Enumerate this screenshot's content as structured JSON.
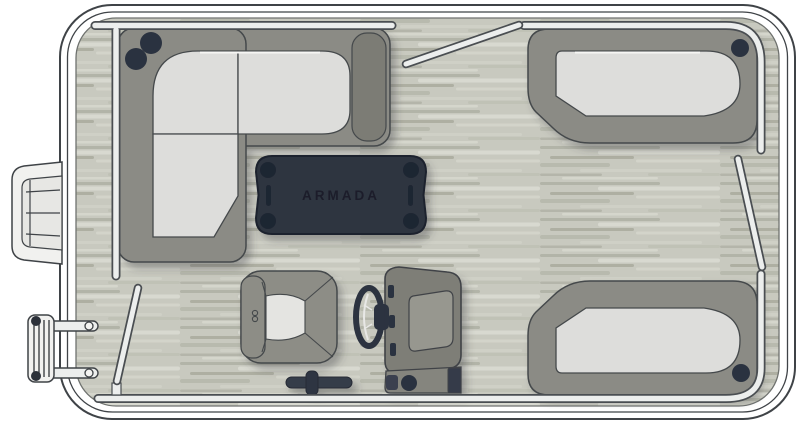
{
  "diagram": {
    "type": "pontoon-boat-floorplan-top-view",
    "brand_label": "ARMADA",
    "colors": {
      "hull_fill": "#ffffff",
      "outline": "#3f4347",
      "deck_base": "#c8c9bf",
      "deck_streak_dark": "#aeb0a4",
      "deck_streak_light": "#d9dad1",
      "furniture_base": "#8b8b85",
      "furniture_shade": "#7c7c75",
      "cushion": "#dddddb",
      "rail_fill": "#eceeed",
      "rail_casing": "#4a4e52",
      "dark_navy": "#2e3440",
      "table_detail": "#1f2531",
      "shadow": "rgba(58,61,66,0.35)"
    },
    "components": [
      "hull",
      "deck",
      "bow-boarding-step",
      "stern-boarding-ladder",
      "port-bow-l-lounge",
      "starboard-bow-lounge",
      "starboard-stern-lounge",
      "center-table",
      "captain-chair",
      "steering-wheel",
      "helm-console",
      "throttle-lever",
      "fence-rails",
      "gate-top",
      "gate-port",
      "gate-starboard",
      "cup-holders"
    ]
  }
}
